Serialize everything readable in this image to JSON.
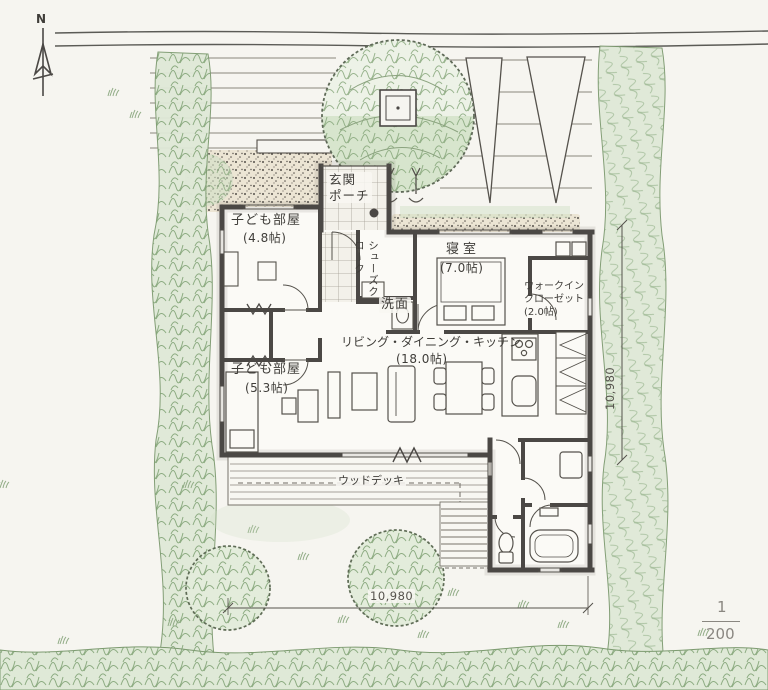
{
  "north": {
    "label": "N"
  },
  "rooms": {
    "entrance_porch": {
      "name": "玄関\nポーチ"
    },
    "shoe_closet": {
      "name": "シューズクローク"
    },
    "kids_room_1": {
      "name": "子ども部屋",
      "size": "(4.8帖)"
    },
    "bedroom": {
      "name": "寝室",
      "size": "(7.0帖)"
    },
    "walk_in_closet": {
      "name": "ウォークイン\nクローゼット\n(2.0帖)"
    },
    "washroom": {
      "name": "洗面"
    },
    "ldk": {
      "name": "リビング・ダイニング・キッチン",
      "size": "(18.0帖)"
    },
    "kids_room_2": {
      "name": "子ども部屋",
      "size": "(5.3帖)"
    },
    "wood_deck": {
      "name": "ウッドデッキ"
    }
  },
  "dimensions": {
    "right": "10,980",
    "bottom": "10,980"
  },
  "scale": {
    "numerator": "1",
    "denominator": "200"
  },
  "colors": {
    "paper": "#f6f5f0",
    "ink": "#4b4845",
    "green_wash": "#cfe0c4",
    "green_line": "#7fa173",
    "stipple_bg": "#ece5d4",
    "scale_text": "#8a8781"
  }
}
